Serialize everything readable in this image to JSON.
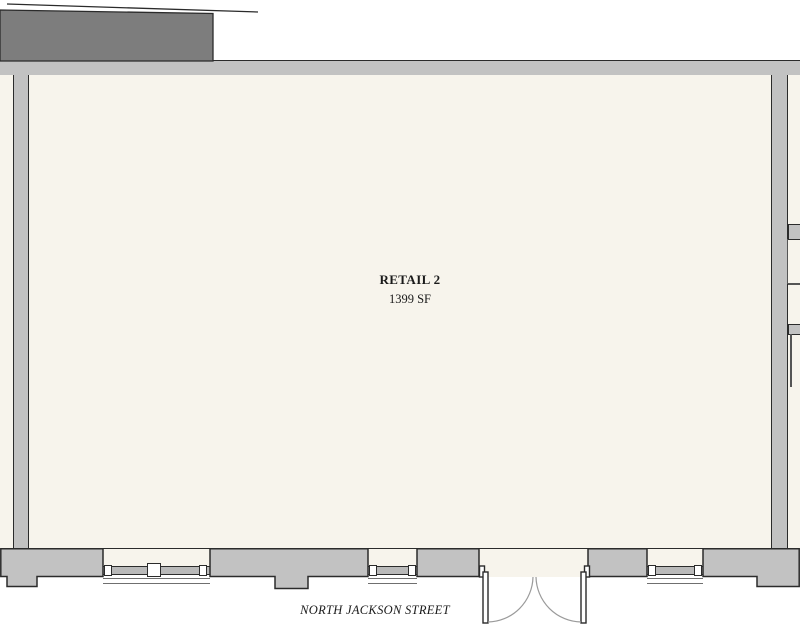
{
  "plan": {
    "title": "Retail floor plan",
    "room": {
      "name": "RETAIL 2",
      "area": "1399 SF"
    },
    "street": {
      "label": "NORTH JACKSON STREET"
    },
    "door": {
      "type": "double-out-swing",
      "location": "south storefront"
    },
    "window_count": 3
  },
  "colors": {
    "exterior": "#ffffff",
    "interior": "#f7f4ec",
    "wall": "#c2c2c2",
    "roof": "#7d7d7d",
    "outline": "#2b2b2b",
    "swing": "#9a9a9a",
    "glazing": "#b9b9b9",
    "text": "#1a1a1a"
  }
}
